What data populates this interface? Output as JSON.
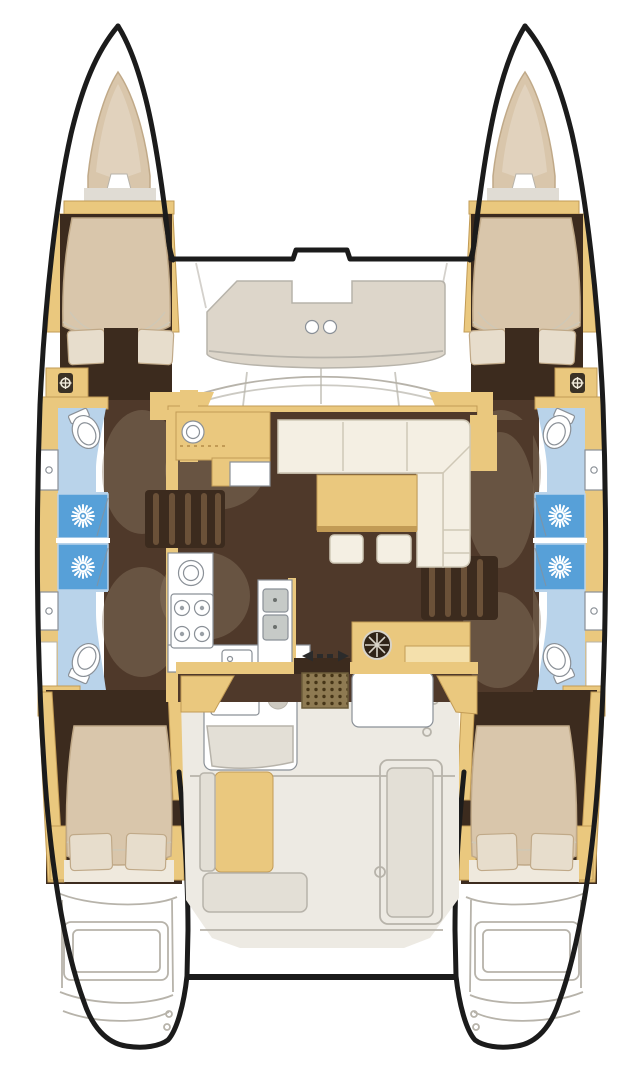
{
  "figure": {
    "type": "floorplan",
    "subject": "Catamaran sailing yacht interior layout, top-down deck plan, bow up",
    "view": "plan view",
    "text_on_image": ""
  },
  "colors": {
    "outline": "#1b1b1b",
    "hull_fill": "#ffffff",
    "wood": "#eac87e",
    "wood_dark": "#c29b55",
    "wood_pale": "#f4e0ac",
    "bed": "#d9c6ab",
    "bed_shade": "#c0a988",
    "pillow": "#e7ddcc",
    "floor_brown": "#4f392a",
    "floor_dark": "#3c2b1e",
    "shadow": "#8d7a64",
    "bath_blue": "#b9d3ea",
    "shower_blue": "#57a0d8",
    "cream": "#f4efe3",
    "cream_seam": "#cfc8b6",
    "deck": "#edeae3",
    "deck_line": "#b7b3aa",
    "bench": "#e3dfd6",
    "seat_pad": "#ddd6ca",
    "white": "#ffffff",
    "grate": "#8e7a52",
    "grate_dot": "#463517",
    "steel": "#c6cac7",
    "fixture_line": "#8a9097",
    "arrow": "#2b2b2b"
  },
  "icons": [
    "helm-wheel-icon",
    "shower-head-icon",
    "toilet-icon",
    "sink-icon",
    "stove-burner-icon",
    "compass-icon",
    "sliding-door-arrow-icon",
    "companionway-grate-icon"
  ],
  "rooms": [
    "forepeak-port",
    "forepeak-starboard",
    "forward-cabin-port",
    "forward-cabin-starboard",
    "forward-bathroom-port",
    "forward-bathroom-starboard",
    "shower-stalls-port",
    "shower-stalls-starboard",
    "aft-cabin-port",
    "aft-cabin-starboard",
    "salon",
    "galley",
    "nav-station",
    "foredeck-lounge",
    "cockpit",
    "swim-platform-port",
    "swim-platform-starboard"
  ]
}
